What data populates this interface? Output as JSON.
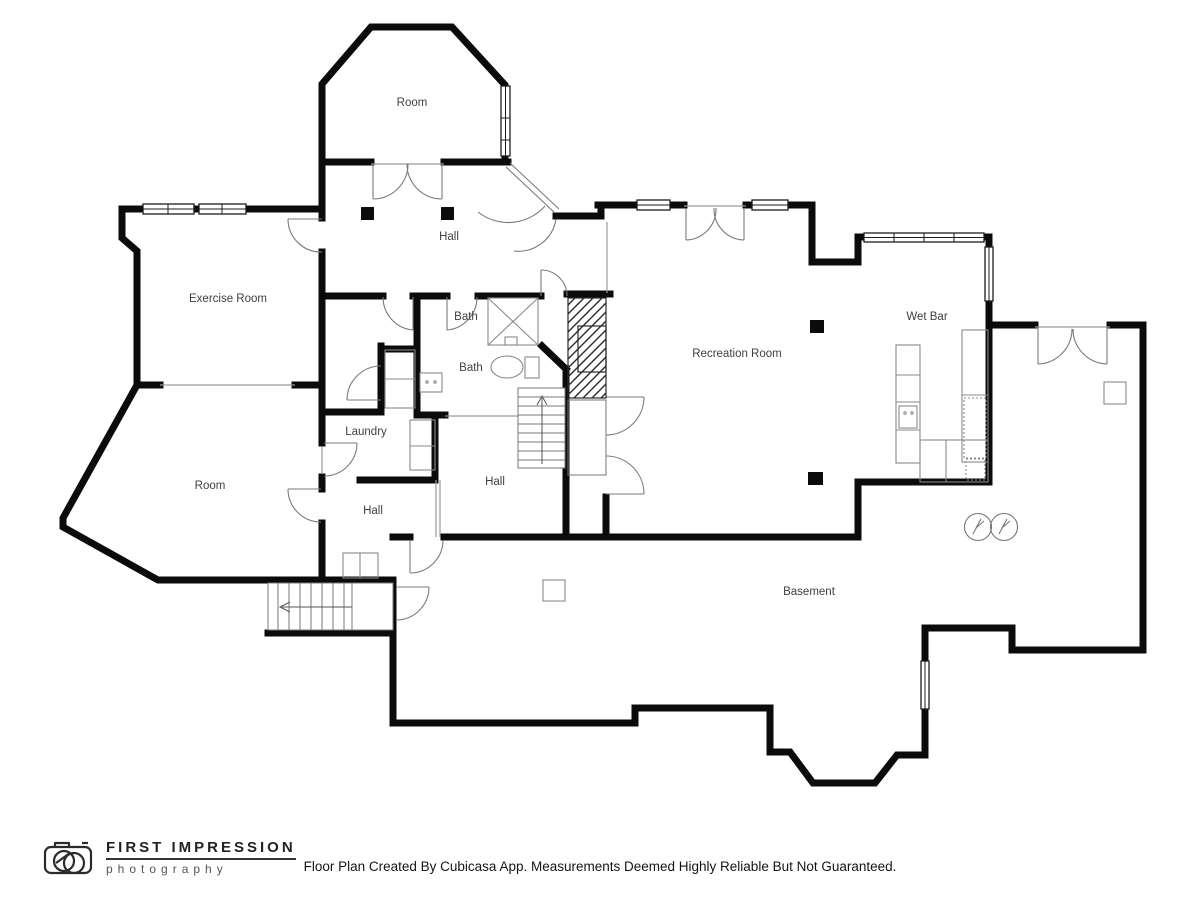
{
  "plan": {
    "labels": [
      {
        "id": "room-top",
        "text": "Room"
      },
      {
        "id": "hall-upper",
        "text": "Hall"
      },
      {
        "id": "exercise-room",
        "text": "Exercise Room"
      },
      {
        "id": "bath-upper",
        "text": "Bath"
      },
      {
        "id": "bath-lower",
        "text": "Bath"
      },
      {
        "id": "wet-bar",
        "text": "Wet Bar"
      },
      {
        "id": "recreation-room",
        "text": "Recreation Room"
      },
      {
        "id": "laundry",
        "text": "Laundry"
      },
      {
        "id": "room-left",
        "text": "Room"
      },
      {
        "id": "hall-center",
        "text": "Hall"
      },
      {
        "id": "hall-lower",
        "text": "Hall"
      },
      {
        "id": "basement",
        "text": "Basement"
      }
    ]
  },
  "logo": {
    "line1": "FIRST IMPRESSION",
    "line2": "photography"
  },
  "footer": {
    "disclaimer": "Floor Plan Created By Cubicasa App. Measurements Deemed Highly Reliable But Not Guaranteed."
  },
  "colors": {
    "wall": "#0b0b0b",
    "thin_line": "#8a8a8a",
    "door_arc": "#777777",
    "label_text": "#3f3f3f",
    "background": "#ffffff"
  }
}
